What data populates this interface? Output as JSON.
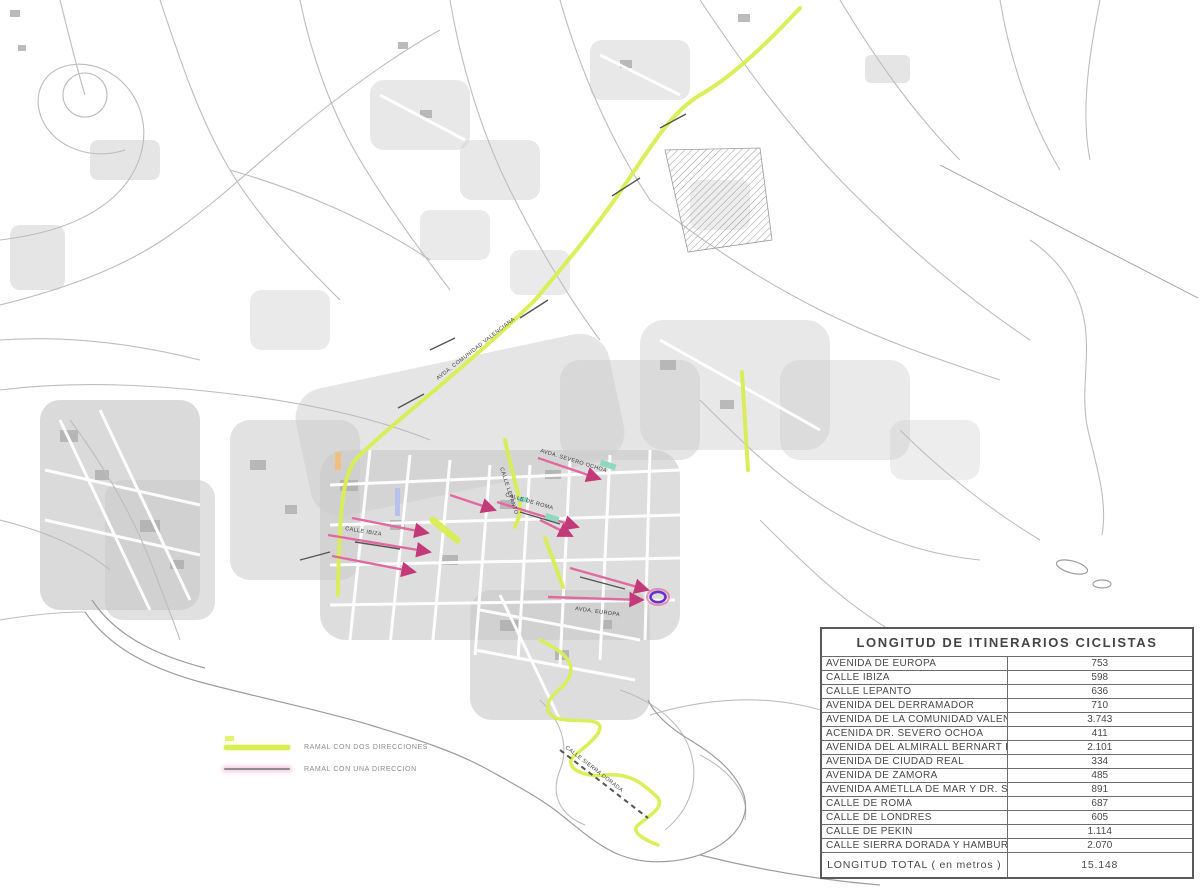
{
  "map": {
    "colors": {
      "two_way_route": "#d9ee53",
      "one_way_route": "#e06a9e",
      "arrow": "#c23a78",
      "urban_fabric": "#cbcbcb",
      "roads": "#bdbdbd",
      "endpoint_oval": "#6633cc",
      "teal_mark": "#8fd8c0"
    },
    "legend": {
      "items": [
        {
          "label": "RAMAL CON DOS DIRECCIONES",
          "type": "two-way"
        },
        {
          "label": "RAMAL CON UNA DIRECCION",
          "type": "one-way"
        }
      ]
    },
    "route_labels": [
      "AVDA. COMUNIDAD VALENCIANA",
      "CALLE LEPANTO",
      "CALLE IBIZA",
      "AVDA. SEVERO OCHOA",
      "CALLE SIERRA DORADA",
      "AVDA. EUROPA",
      "CALLE DE ROMA"
    ]
  },
  "table": {
    "title": "LONGITUD DE ITINERARIOS CICLISTAS",
    "rows": [
      {
        "name": "AVENIDA DE EUROPA",
        "value": "753"
      },
      {
        "name": "CALLE IBIZA",
        "value": "598"
      },
      {
        "name": "CALLE LEPANTO",
        "value": "636"
      },
      {
        "name": "AVENIDA DEL DERRAMADOR",
        "value": "710"
      },
      {
        "name": "AVENIDA DE LA COMUNIDAD VALENCIANA",
        "value": "3.743"
      },
      {
        "name": "ACENIDA DR. SEVERO OCHOA",
        "value": "411"
      },
      {
        "name": "AVENIDA DEL ALMIRALL BERNART DE SARRIA",
        "value": "2.101"
      },
      {
        "name": "AVENIDA DE CIUDAD REAL",
        "value": "334"
      },
      {
        "name": "AVENIDA DE ZAMORA",
        "value": "485"
      },
      {
        "name": "AVENIDA AMETLLA DE MAR Y DR. SEVERO OCHOA",
        "value": "891"
      },
      {
        "name": "CALLE DE ROMA",
        "value": "687"
      },
      {
        "name": "CALLE DE LONDRES",
        "value": "605"
      },
      {
        "name": "CALLE DE PEKIN",
        "value": "1.114"
      },
      {
        "name": "CALLE SIERRA DORADA Y HAMBURGO",
        "value": "2.070"
      }
    ],
    "total_label": "LONGITUD TOTAL ( en metros )",
    "total_value": "15.148"
  }
}
